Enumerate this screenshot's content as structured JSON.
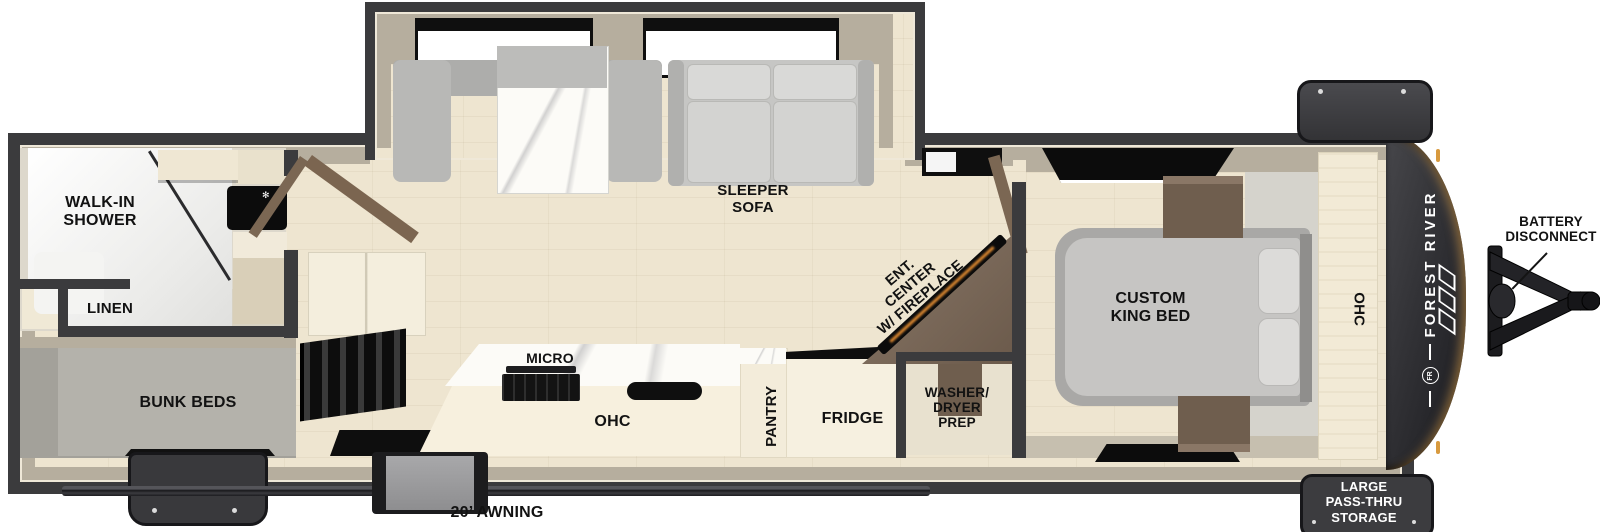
{
  "palette": {
    "wall": "#3b3b3d",
    "wall_face": "#b6ae9e",
    "trim": "#efe8d8",
    "wood_floor": "#eee5d0",
    "gray_floor": "#a3a19a",
    "cabinet_cream": "#f4eedd",
    "dark_wood": "#77665a",
    "appliance_black": "#111111",
    "fireplace_glow": "#e08a30",
    "front_cap": "#2a2a2e",
    "marker_amber": "#d89a3e",
    "label_dark": "#121212",
    "label_light": "#ffffff"
  },
  "labels": {
    "walk_in_shower": {
      "lines": [
        "WALK-IN",
        "SHOWER"
      ]
    },
    "linen": {
      "text": "LINEN"
    },
    "bunk_beds": {
      "text": "BUNK BEDS"
    },
    "sleeper_sofa": {
      "lines": [
        "SLEEPER",
        "SOFA"
      ]
    },
    "micro": {
      "text": "MICRO"
    },
    "kitchen_ohc": {
      "text": "OHC"
    },
    "pantry": {
      "text": "PANTRY"
    },
    "fridge": {
      "text": "FRIDGE"
    },
    "ent_center": {
      "lines": [
        "ENT.",
        "CENTER",
        "W/ FIREPLACE"
      ]
    },
    "washer_dryer": {
      "lines": [
        "WASHER/",
        "DRYER",
        "PREP"
      ]
    },
    "custom_king_bed": {
      "lines": [
        "CUSTOM",
        "KING BED"
      ]
    },
    "bedroom_ohc": {
      "text": "OHC"
    },
    "battery_disconnect": {
      "lines": [
        "BATTERY",
        "DISCONNECT"
      ]
    },
    "pass_thru_storage": {
      "lines": [
        "LARGE",
        "PASS-THRU",
        "STORAGE"
      ]
    },
    "awning": {
      "text": "20’ AWNING"
    },
    "brand": {
      "name": "FOREST RIVER",
      "monogram": "FR"
    }
  }
}
